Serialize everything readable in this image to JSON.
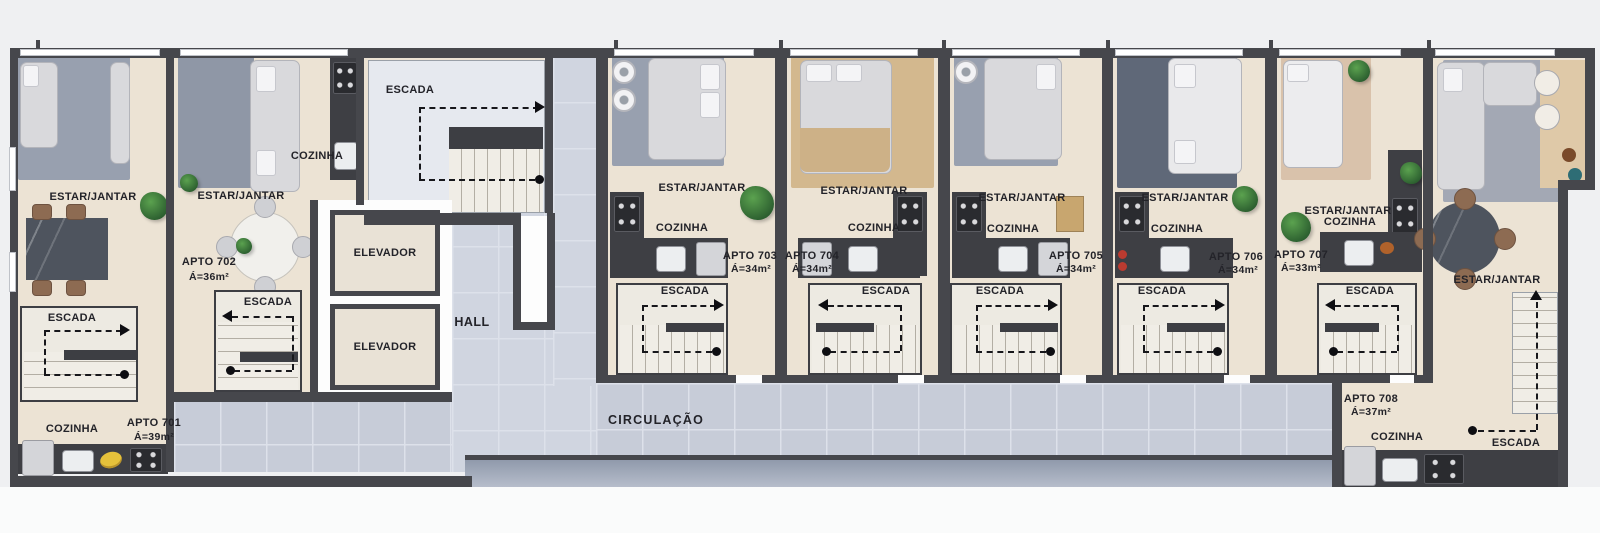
{
  "plan_type": "floor-plan",
  "room_labels": {
    "estar_jantar": "ESTAR/JANTAR",
    "cozinha": "COZINHA",
    "escada": "ESCADA",
    "elevador": "ELEVADOR",
    "hall": "HALL",
    "circulacao": "CIRCULAÇÃO"
  },
  "apartments": [
    {
      "id": "701",
      "name": "APTO 701",
      "area": "Á=39m²"
    },
    {
      "id": "702",
      "name": "APTO 702",
      "area": "Á=36m²"
    },
    {
      "id": "703",
      "name": "APTO 703",
      "area": "Á=34m²"
    },
    {
      "id": "704",
      "name": "APTO 704",
      "area": "Á=34m²"
    },
    {
      "id": "705",
      "name": "APTO 705",
      "area": "Á=34m²"
    },
    {
      "id": "706",
      "name": "APTO 706",
      "area": "Á=34m²"
    },
    {
      "id": "707",
      "name": "APTO 707",
      "area": "Á=33m²"
    },
    {
      "id": "708",
      "name": "APTO 708",
      "area": "Á=37m²"
    }
  ],
  "colors": {
    "background": "#eff0f2",
    "wall": "#46474c",
    "floor_beige": "#ece3d4",
    "corridor_tile": "#c7ccd8",
    "carpet_gray": "#98a0af",
    "carpet_tan": "#d3b88e",
    "carpet_dark": "#5f6878",
    "stair": "#edeae2",
    "counter_dark": "#3e3f44",
    "text": "#232329",
    "plant_green": "#3f8a3c"
  }
}
